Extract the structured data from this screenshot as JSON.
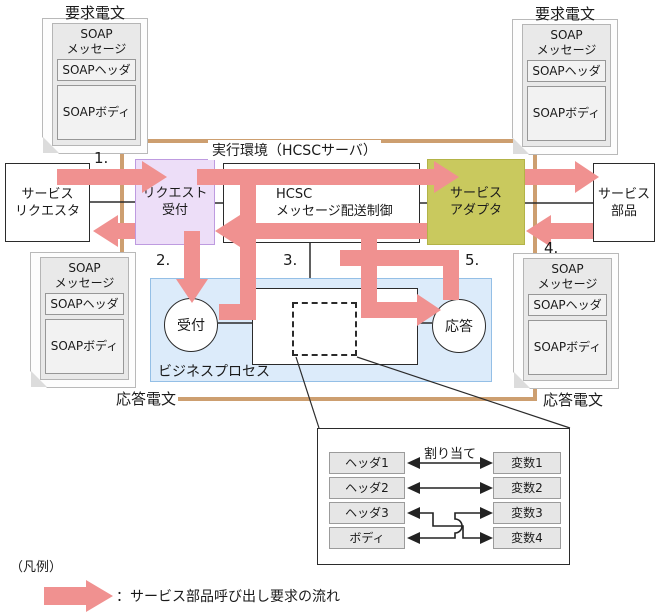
{
  "env_label": "実行環境（HCSCサーバ）",
  "documents": {
    "top_left_label": "要求電文",
    "top_right_label": "要求電文",
    "bottom_left_label": "応答電文",
    "bottom_right_label": "応答電文",
    "soap_message_line1": "SOAP",
    "soap_message_line2": "メッセージ",
    "soap_header": "SOAPヘッダ",
    "soap_body": "SOAPボディ"
  },
  "boxes": {
    "service_requester_line1": "サービス",
    "service_requester_line2": "リクエスタ",
    "request_reception_line1": "リクエスト",
    "request_reception_line2": "受付",
    "hcsc_line1": "HCSC",
    "hcsc_line2": "メッセージ配送制御",
    "service_adapter_line1": "サービス",
    "service_adapter_line2": "アダプタ",
    "service_parts_line1": "サービス",
    "service_parts_line2": "部品"
  },
  "business_process": {
    "label": "ビジネスプロセス",
    "reception": "受付",
    "reply": "応答"
  },
  "steps": [
    "1.",
    "2.",
    "3.",
    "4.",
    "5."
  ],
  "mapping": {
    "title": "割り当て",
    "left": [
      "ヘッダ1",
      "ヘッダ2",
      "ヘッダ3",
      "ボディ"
    ],
    "right": [
      "変数1",
      "変数2",
      "変数3",
      "変数4"
    ]
  },
  "legend": {
    "title": "（凡例）",
    "description": "：サービス部品呼び出し要求の流れ"
  },
  "colors": {
    "flow_arrow": "#F09190",
    "request_reception_fill": "#EDDEF8",
    "service_adapter_fill": "#C9C95E",
    "business_process_fill": "#DCEBFA",
    "frame": "#CD9F70"
  }
}
